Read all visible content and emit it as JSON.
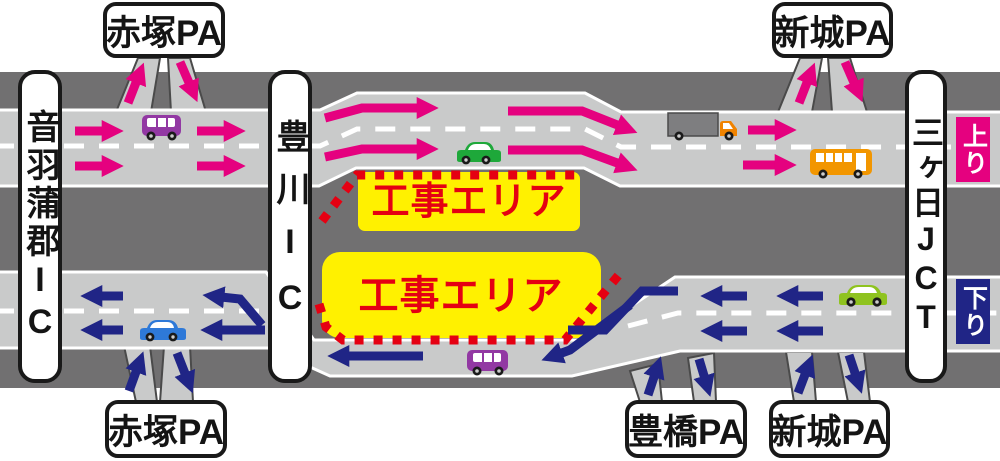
{
  "signs": {
    "ic_left": "音羽蒲郡IC",
    "ic_middle": "豊川IC",
    "jct_right": "三ヶ日JCT",
    "pa_top_left": "赤塚PA",
    "pa_top_right": "新城PA",
    "pa_bottom_left": "赤塚PA",
    "pa_bottom_center": "豊橋PA",
    "pa_bottom_right": "新城PA"
  },
  "directions": {
    "up_label": "上り",
    "down_label": "下り"
  },
  "construction": {
    "area_top": {
      "label": "工事エリア"
    },
    "area_bottom": {
      "label": "工事エリア"
    }
  },
  "colors": {
    "up_direction_arrow": "#E5017F",
    "down_direction_arrow": "#202586",
    "roadway": "#C9CACA",
    "median": "#717071",
    "lane_marking": "#FFFFFF",
    "construction_fill": "#FFF100",
    "construction_text": "#E50012",
    "construction_border": "#E50012",
    "sign_border": "#191919"
  },
  "vehicles": {
    "up_roadway": [
      "purple-van",
      "green-car",
      "gray-truck",
      "orange-bus"
    ],
    "down_roadway": [
      "blue-car",
      "purple-van",
      "lime-car"
    ]
  }
}
